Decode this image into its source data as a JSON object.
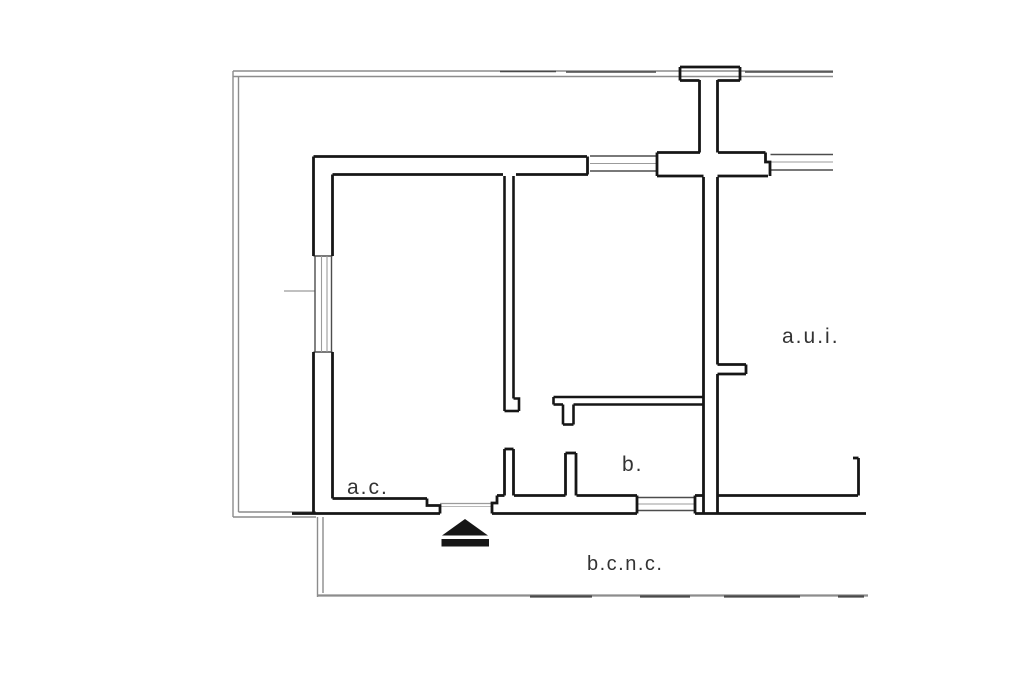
{
  "floor_plan": {
    "labels": {
      "unit_ac": "a.c.",
      "room_b": "b.",
      "unit_aui": "a.u.i.",
      "common_area_bcnc": "b.c.n.c."
    },
    "icons": {
      "entrance_arrow": "entrance-arrow-icon"
    },
    "colors": {
      "wall": "#161616",
      "boundary_gray": "#8c8c8c",
      "boundary_dark": "#4a4a4a",
      "window_line": "#4d4d4d",
      "window_line_light": "#9b9b9b",
      "label_text": "#333333",
      "background": "#ffffff"
    }
  }
}
